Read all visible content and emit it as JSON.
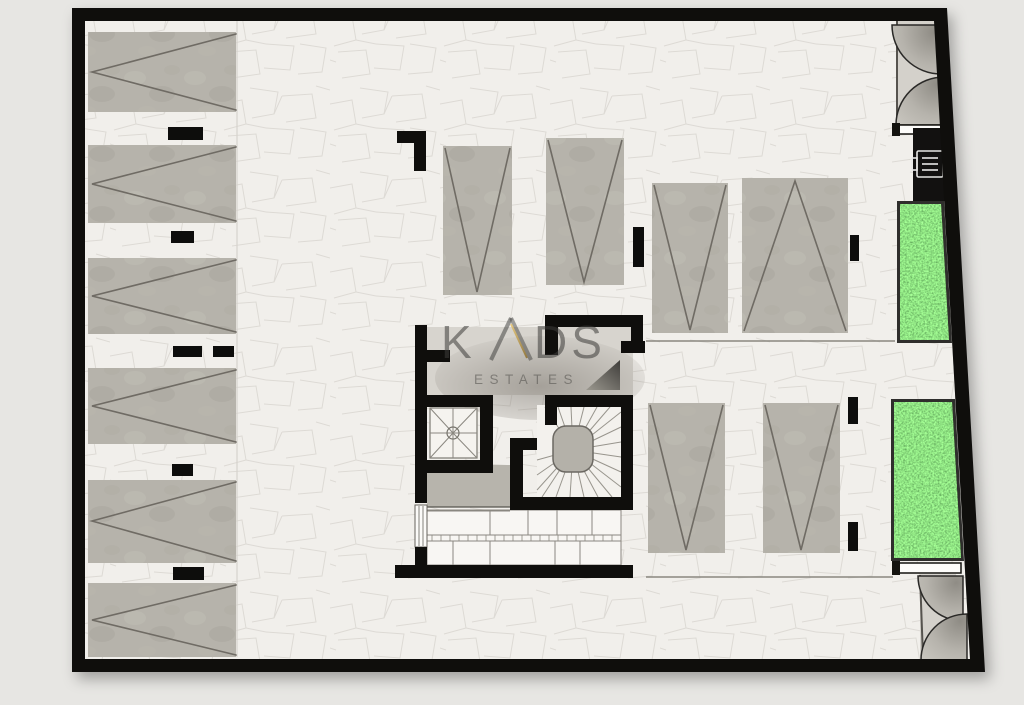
{
  "watermark": {
    "k": "K",
    "rest": "DS",
    "subtitle": "ESTATES"
  },
  "palette": {
    "outside": "#e7e6e3",
    "floor": "#f1efeb",
    "wall": "#0f0e0c",
    "parking_fill": "#b6b3ab",
    "marking_line": "#6f6b64",
    "grass_green": "#4f9e33",
    "door_leaf_gray": "#b3b0aa",
    "accent_gold": "#b9913f",
    "watermark_gray": "#3d3c3a"
  },
  "plan": {
    "type": "parking-basement-floor-plan",
    "parking_spaces_left_column": 6,
    "parking_spaces_top_center": 2,
    "parking_spaces_right_upper": 2,
    "parking_spaces_right_lower": 2,
    "green_planters": 2,
    "entry_gates": 2,
    "core_features": [
      "elevator-shaft",
      "winding-staircase",
      "storage-row",
      "lobby-door"
    ],
    "utility": "electric-meter-panel"
  }
}
